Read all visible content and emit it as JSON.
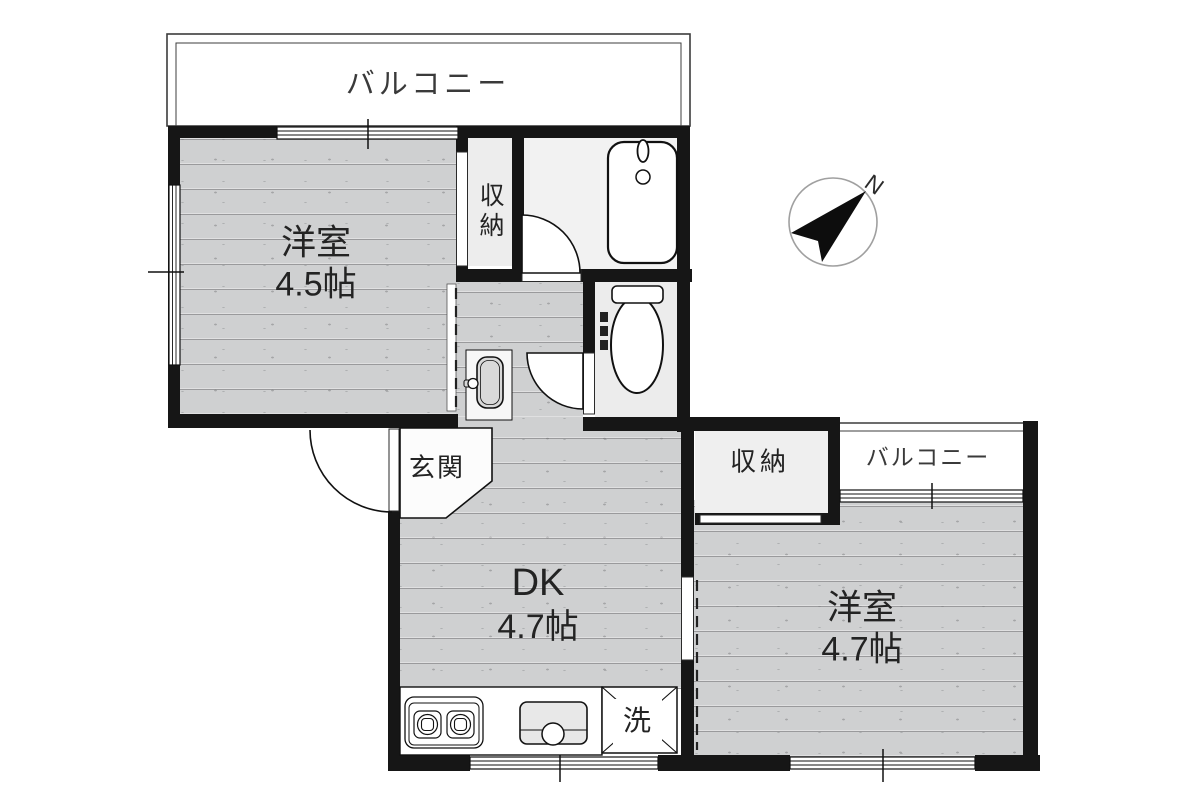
{
  "plan": {
    "compass": {
      "north_label": "N"
    },
    "balcony_top": {
      "label": "バルコニー"
    },
    "balcony_right": {
      "label": "バルコニー"
    },
    "rooms": {
      "western_room_1": {
        "name": "洋室",
        "size": "4.5帖"
      },
      "western_room_2": {
        "name": "洋室",
        "size": "4.7帖"
      },
      "dining_kitchen": {
        "name": "DK",
        "size": "4.7帖"
      },
      "closet_upper": {
        "label": "収納"
      },
      "closet_right": {
        "label": "収納"
      },
      "entrance": {
        "label": "玄関"
      },
      "laundry": {
        "label": "洗"
      }
    },
    "fixtures": [
      "bathtub",
      "toilet",
      "washbasin",
      "stove-2-burner",
      "kitchen-sink",
      "laundry-pan"
    ],
    "colors": {
      "wall": "#161616",
      "wood_floor": "#cfd0d1",
      "bath_floor": "#f2f2f2",
      "toilet_floor": "#ececec",
      "closet_floor": "#ededed",
      "outline": "#111111",
      "compass_ring": "#a0a0a0"
    }
  }
}
